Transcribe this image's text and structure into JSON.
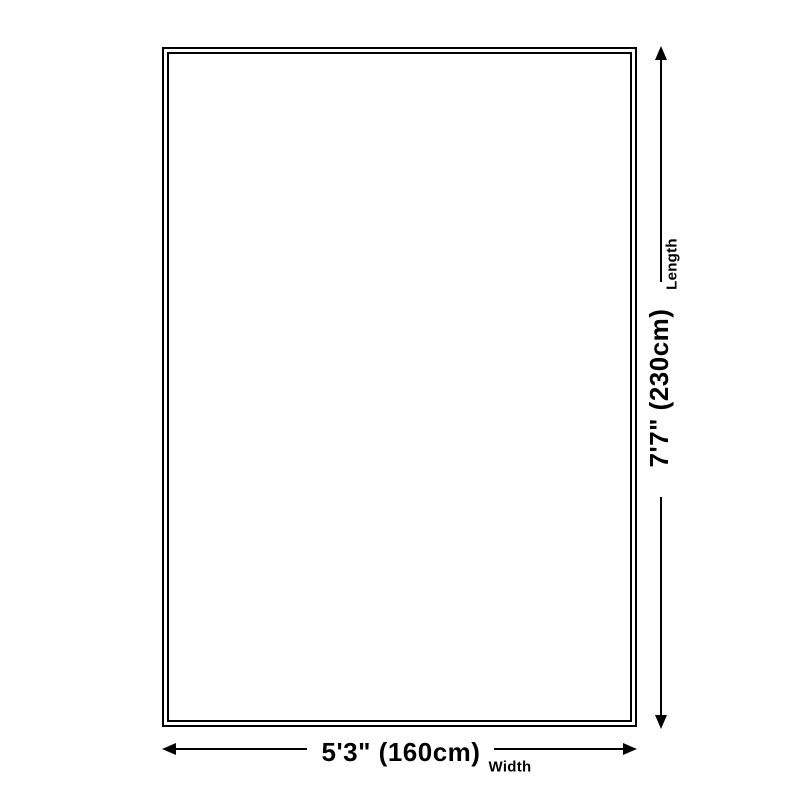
{
  "diagram": {
    "title": "rug-size-diagram",
    "colors": {
      "ink": "#000000",
      "background": "#ffffff"
    },
    "length": {
      "value": "7'7\" (230cm)",
      "label": "Length"
    },
    "width": {
      "value": "5'3\" (160cm)",
      "label": "Width"
    }
  }
}
